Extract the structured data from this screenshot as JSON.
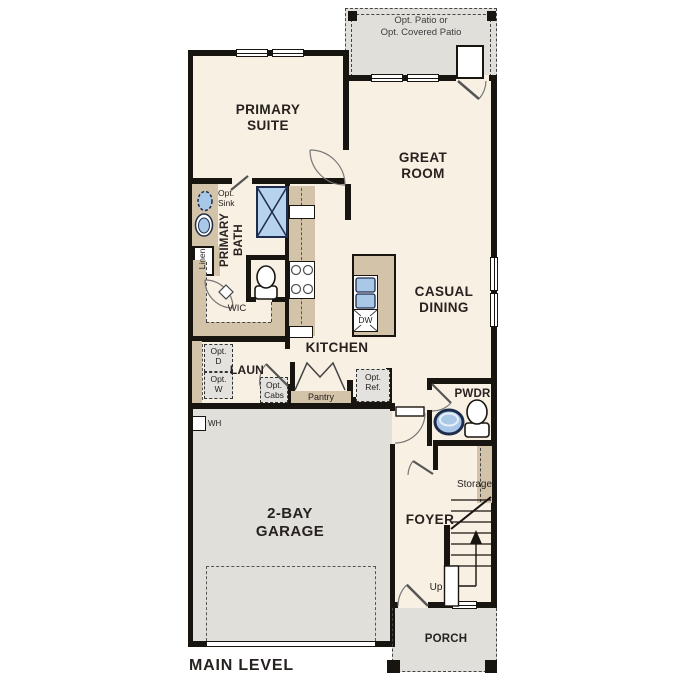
{
  "title": "MAIN LEVEL",
  "labels": {
    "patio": "Opt. Patio or\nOpt. Covered Patio",
    "primary_suite": "PRIMARY\nSUITE",
    "great_room": "GREAT\nROOM",
    "opt_sink": "Opt.\nSink",
    "primary_bath": "PRIMARY\nBATH",
    "linen": "Linen",
    "wic": "WIC",
    "casual_dining": "CASUAL\nDINING",
    "dw": "DW",
    "kitchen": "KITCHEN",
    "laun": "LAUN",
    "opt_d": "Opt.\nD",
    "opt_w": "Opt.\nW",
    "opt_cabs": "Opt.\nCabs",
    "pantry": "Pantry",
    "opt_ref": "Opt.\nRef.",
    "pwdr": "PWDR",
    "wh": "WH",
    "storage": "Storage",
    "foyer": "FOYER",
    "up": "Up",
    "garage": "2-BAY\nGARAGE",
    "porch": "PORCH",
    "level_title": "MAIN LEVEL"
  },
  "colors": {
    "wall": "#181410",
    "interior_floor": "#f8f0e2",
    "garage_patio_porch": "#e0dfda",
    "cabinet_tan": "#d3c3a9",
    "fixture_blue": "#a9c8e8",
    "shower_blue": "#b7d2ec",
    "fixture_outline_navy": "#1d2c4c",
    "text": "#272220"
  }
}
